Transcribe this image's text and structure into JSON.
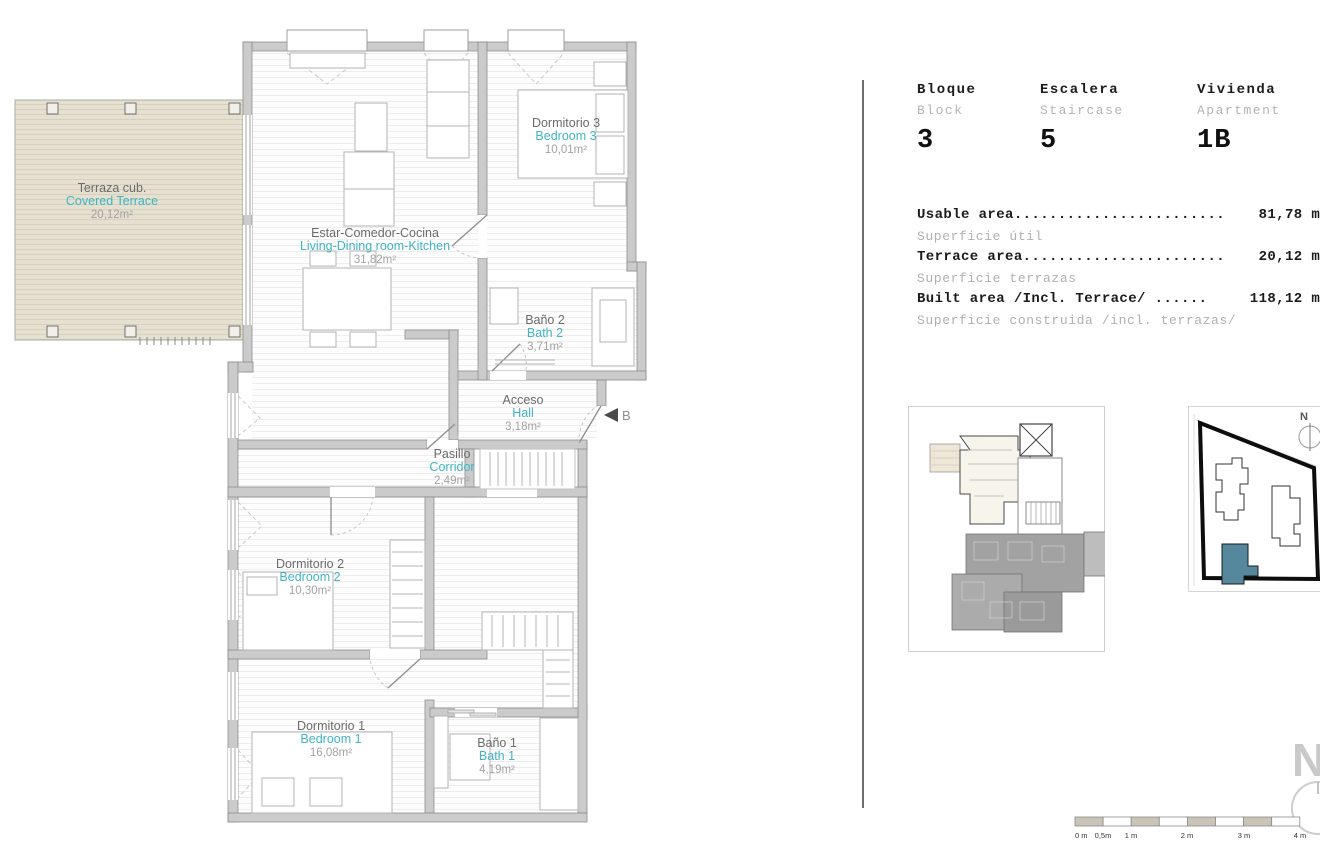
{
  "floor_plan": {
    "rooms": [
      {
        "id": "terrace",
        "name_es": "Terraza cub.",
        "name_en": "Covered Terrace",
        "area": "20,12m²"
      },
      {
        "id": "living",
        "name_es": "Estar-Comedor-Cocina",
        "name_en": "Living-Dining room-Kitchen",
        "area": "31,82m²"
      },
      {
        "id": "bedroom3",
        "name_es": "Dormitorio 3",
        "name_en": "Bedroom 3",
        "area": "10,01m²"
      },
      {
        "id": "bath2",
        "name_es": "Baño 2",
        "name_en": "Bath 2",
        "area": "3,71m²"
      },
      {
        "id": "hall",
        "name_es": "Acceso",
        "name_en": "Hall",
        "area": "3,18m²"
      },
      {
        "id": "corridor",
        "name_es": "Pasillo",
        "name_en": "Corridor",
        "area": "2,49m²"
      },
      {
        "id": "bedroom2",
        "name_es": "Dormitorio 2",
        "name_en": "Bedroom 2",
        "area": "10,30m²"
      },
      {
        "id": "bedroom1",
        "name_es": "Dormitorio 1",
        "name_en": "Bedroom 1",
        "area": "16,08m²"
      },
      {
        "id": "bath1",
        "name_es": "Baño 1",
        "name_en": "Bath 1",
        "area": "4,19m²"
      }
    ],
    "entrance_marker": "B"
  },
  "info_panel": {
    "header": [
      {
        "label_es": "Bloque",
        "label_en": "Block",
        "value": "3"
      },
      {
        "label_es": "Escalera",
        "label_en": "Staircase",
        "value": "5"
      },
      {
        "label_es": "Vivienda",
        "label_en": "Apartment",
        "value": "1B"
      }
    ],
    "areas": [
      {
        "label_en": "Usable area........................",
        "label_es": "Superficie útil",
        "value": "81,78 m²"
      },
      {
        "label_en": "Terrace area.......................",
        "label_es": "Superficie terrazas",
        "value": "20,12 m²"
      },
      {
        "label_en": "Built area /Incl. Terrace/ ......",
        "label_es": "Superficie construida /incl. terrazas/",
        "value": "118,12 m²"
      }
    ]
  },
  "scale_bar": {
    "labels": [
      "0 m",
      "0,5m",
      "1 m",
      "2 m",
      "3 m",
      "4 m"
    ]
  },
  "north_label": "N",
  "colors": {
    "teal_text": "#3fb4c4",
    "terrace_fill": "#e6e0d1",
    "wall_gray": "#cbcbcb",
    "site_highlight": "#55889c"
  }
}
